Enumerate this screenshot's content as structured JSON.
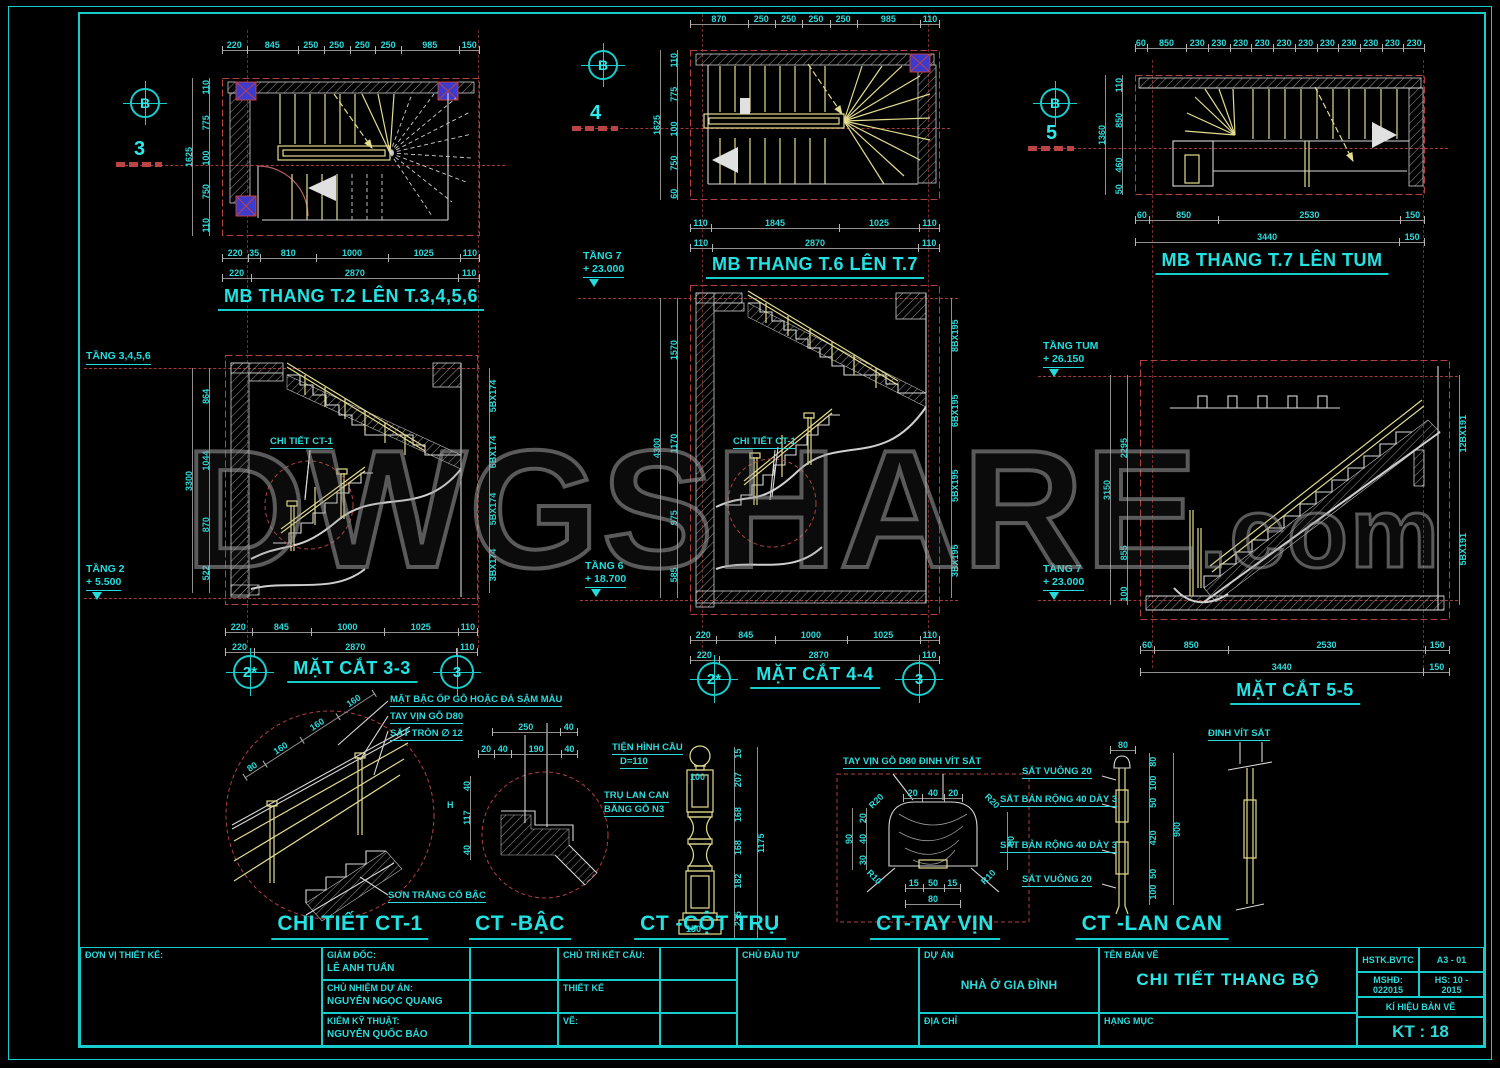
{
  "colors": {
    "accent_cyan": "#19cccc",
    "dim_red": "#b24040",
    "stair_yellow": "#e3dc8f",
    "column_blue": "#3b3bd0"
  },
  "watermark": {
    "main": "DWGSHARE",
    "suffix": ".com"
  },
  "plans": {
    "p1": {
      "title": "MB THANG T.2 LÊN T.3,4,5,6",
      "grid_bubble": "B",
      "section_marker": "3",
      "top_dims": [
        "220",
        "845",
        "250",
        "250",
        "250",
        "250",
        "985",
        "150"
      ],
      "left_dims": [
        "110",
        "775",
        "100",
        "750",
        "110"
      ],
      "left_total": [
        "1625"
      ],
      "bottom_dims1": [
        "220",
        "35",
        "810",
        "1000",
        "1025",
        "110"
      ],
      "bottom_dims2": [
        "220",
        "2870",
        "110"
      ]
    },
    "p2": {
      "title": "MB THANG T.6 LÊN T.7",
      "grid_bubble": "B",
      "section_marker": "4",
      "top_dims": [
        "870",
        "250",
        "250",
        "250",
        "250",
        "985",
        "110"
      ],
      "left_dims": [
        "110",
        "775",
        "100",
        "750",
        "60"
      ],
      "left_total": [
        "1625"
      ],
      "bottom_dims1": [
        "110",
        "1845",
        "1025",
        "110"
      ],
      "bottom_dims2": [
        "110",
        "2870",
        "110"
      ]
    },
    "p3": {
      "title": "MB THANG T.7 LÊN TUM",
      "grid_bubble": "B",
      "section_marker": "5",
      "top_dims": [
        "60",
        "850",
        "230",
        "230",
        "230",
        "230",
        "230",
        "230",
        "230",
        "230",
        "230",
        "230",
        "230"
      ],
      "left_dims": [
        "110",
        "850",
        "460",
        "50"
      ],
      "left_total": [
        "1360"
      ],
      "bottom_dims1": [
        "60",
        "850",
        "2530",
        "150"
      ],
      "bottom_dims2": [
        "3440",
        "150"
      ]
    }
  },
  "sections": {
    "s33": {
      "title": "MẶT CẮT 3-3",
      "bubble_left": "2*",
      "bubble_right": "3",
      "level_top_name": "TẦNG 3,4,5,6",
      "level_top_elev": "",
      "level_bottom_name": "TẦNG 2",
      "level_bottom_elev": "+ 5.500",
      "left_dims": [
        "864",
        "1044",
        "870",
        "522"
      ],
      "left_total": [
        "3300"
      ],
      "right_dims": [
        "5BX174",
        "6BX174",
        "5BX174",
        "3BX174"
      ],
      "detail_label": "CHI TIẾT CT-1",
      "bottom_dims1": [
        "220",
        "845",
        "1000",
        "1025",
        "110"
      ],
      "bottom_dims2": [
        "220",
        "2870",
        "110"
      ]
    },
    "s44": {
      "title": "MẶT CẮT 4-4",
      "bubble_left": "2*",
      "bubble_right": "3",
      "level_top_name": "TẦNG 7",
      "level_top_elev": "+ 23.000",
      "level_bottom_name": "TẦNG 6",
      "level_bottom_elev": "+ 18.700",
      "left_dims": [
        "1570",
        "1170",
        "975",
        "585"
      ],
      "left_total": [
        "4300"
      ],
      "right_dims": [
        "8BX195",
        "6BX195",
        "5BX195",
        "3BX195"
      ],
      "detail_label": "CHI TIẾT CT-1",
      "bottom_dims1": [
        "220",
        "845",
        "1000",
        "1025",
        "110"
      ],
      "bottom_dims2": [
        "220",
        "2870",
        "110"
      ]
    },
    "s55": {
      "title": "MẶT CẮT 5-5",
      "level_top_name": "TẦNG TUM",
      "level_top_elev": "+ 26.150",
      "level_bottom_name": "TẦNG 7",
      "level_bottom_elev": "+ 23.000",
      "left_dims": [
        "2295",
        "855",
        "100"
      ],
      "left_total": [
        "3150"
      ],
      "right_dims": [
        "12BX191",
        "5BX191"
      ],
      "bottom_dims1": [
        "60",
        "850",
        "2530",
        "150"
      ],
      "bottom_dims2": [
        "3440",
        "150"
      ]
    }
  },
  "details": {
    "ct1": {
      "title": "CHI TIẾT CT-1",
      "notes": [
        "MẶT BẬC ỐP GỖ HOẶC ĐÁ SẬM MÀU",
        "TAY VỊN GỖ D80",
        "SẮT TRÒN ∅ 12"
      ],
      "note_bottom": "SƠN TRẮNG CỔ BẬC",
      "rail_dims": [
        "80",
        "160",
        "160",
        "160"
      ]
    },
    "bac": {
      "title": "CT -BẬC",
      "top_dims1": [
        "250",
        "40"
      ],
      "top_dims2": [
        "20",
        "40",
        "190",
        "40"
      ],
      "left_dims": [
        "40",
        "117",
        "40"
      ],
      "h_label": "H"
    },
    "cottru": {
      "title": "CT -CỘT TRỤ",
      "note1a": "TIỆN HÌNH CẦU",
      "note1b": "D=110",
      "note2a": "TRỤ LAN CAN",
      "note2b": "BẰNG GỖ N3",
      "w_top": "100",
      "w_base": "150",
      "v_dims": [
        "15",
        "207",
        "168",
        "168",
        "182",
        "235"
      ],
      "v_total": [
        "1175"
      ]
    },
    "tayvin": {
      "title": "CT-TAY VỊN",
      "note": "TAY VỊN GỖ D80 ĐINH VÍT SẮT",
      "top_dims": [
        "20",
        "40",
        "20"
      ],
      "left_dims": [
        "20",
        "40",
        "30"
      ],
      "left_total": [
        "90"
      ],
      "right_dim": [
        "80"
      ],
      "bottom_dims": [
        "15",
        "50",
        "15"
      ],
      "bottom_total": [
        "80"
      ],
      "r_top": "R20",
      "r_top2": "R20",
      "r_bot": "R10",
      "r_bot2": "R10"
    },
    "lancan": {
      "title": "CT -LAN CAN",
      "note_top": "ĐINH VÍT SẮT",
      "notes_left": [
        "SẮT VUÔNG 20",
        "SẮT BẢN RỘNG 40 DÀY 3",
        "SẮT BẢN RỘNG 40 DÀY 3",
        "SẮT VUÔNG 20"
      ],
      "top_dim": [
        "80"
      ],
      "v_dims": [
        "80",
        "100",
        "50",
        "420",
        "50",
        "100"
      ],
      "v_total": [
        "900"
      ]
    }
  },
  "titleblock": {
    "don_vi": "ĐƠN VỊ THIẾT KẾ:",
    "roles": [
      {
        "label": "GIÁM ĐỐC:",
        "name": "LÊ ANH TUẤN"
      },
      {
        "label": "CHỦ NHIỆM DỰ ÁN:",
        "name": "NGUYỄN NGỌC QUANG"
      },
      {
        "label": "KIỂM KỸ THUẬT:",
        "name": "NGUYỄN QUỐC BẢO"
      }
    ],
    "roles2": [
      {
        "label": "CHỦ TRÌ KẾT CẤU:"
      },
      {
        "label": "THIẾT KẾ"
      },
      {
        "label": "VẼ:"
      }
    ],
    "chu_dau_tu": "CHỦ ĐẦU TƯ",
    "du_an_label": "DỰ ÁN",
    "du_an": "NHÀ Ở GIA ĐÌNH",
    "dia_chi": "ĐỊA CHỈ",
    "ten_ban_ve_label": "TÊN BẢN VẼ",
    "ten_ban_ve": "CHI TIẾT THANG BỘ",
    "hang_muc": "HẠNG MỤC",
    "meta_c1": "HSTK.BVTC",
    "meta_c2": "A3 - 01",
    "meta_c3": "MSHĐ: 022015",
    "meta_c4": "HS: 10 - 2015",
    "ky_hieu": "KÍ HIỆU BẢN VẼ",
    "so_hieu": "KT : 18"
  }
}
